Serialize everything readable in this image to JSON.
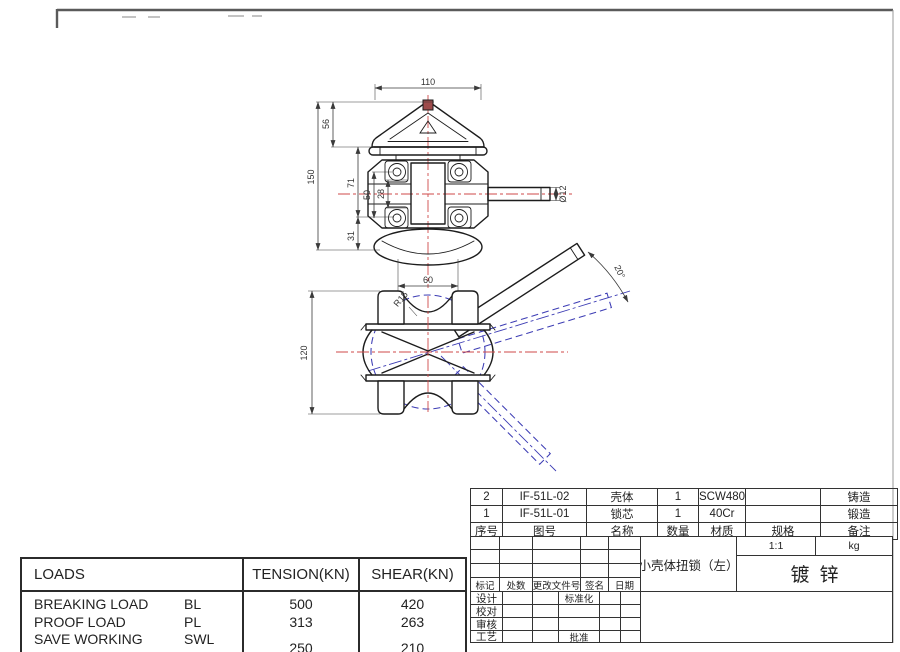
{
  "drawing": {
    "colors": {
      "outline": "#1c1c1c",
      "centerline": "#cf4a4a",
      "alternate_position": "#3c3cb4",
      "dimension": "#3a3a3a"
    },
    "top_view": {
      "dims": {
        "width": "110",
        "head_height": "56",
        "overall_height": "150",
        "body_height": "71",
        "bolt_spacing": "50",
        "inner_spacing": "28",
        "flange_height": "31",
        "flange_width": "60",
        "rod_dia": "Ø12"
      }
    },
    "front_view": {
      "dims": {
        "height": "120",
        "saddle_radius": "R15",
        "handle_angle": "20°"
      }
    }
  },
  "loads_table": {
    "header": {
      "loads": "LOADS",
      "tension": "TENSION(KN)",
      "shear": "SHEAR(KN)"
    },
    "rows": [
      {
        "name": "BREAKING LOAD",
        "abbr": "BL",
        "tension": "500",
        "shear": "420"
      },
      {
        "name": "PROOF LOAD",
        "abbr": "PL",
        "tension": "313",
        "shear": "263"
      },
      {
        "name": "SAVE WORKING LOAD",
        "abbr": "SWL",
        "tension": "250",
        "shear": "210"
      }
    ]
  },
  "parts_table": {
    "header": {
      "seq": "序号",
      "dwg_no": "图号",
      "name": "名称",
      "qty": "数量",
      "material": "材质",
      "spec": "规格",
      "remark": "备注"
    },
    "rows": [
      {
        "seq": "2",
        "dwg_no": "IF-51L-02",
        "name": "壳体",
        "qty": "1",
        "material": "SCW480",
        "spec": "",
        "remark": "铸造"
      },
      {
        "seq": "1",
        "dwg_no": "IF-51L-01",
        "name": "锁芯",
        "qty": "1",
        "material": "40Cr",
        "spec": "",
        "remark": "锻造"
      }
    ]
  },
  "title_block": {
    "title": "小壳体扭锁（左）",
    "scale": "1:1",
    "weight_unit": "kg",
    "finish": "镀锌",
    "revision_header": {
      "mark": "标记",
      "count": "处数",
      "doc_no": "更改文件号",
      "sign": "签名",
      "date": "日期"
    },
    "staff": {
      "design": "设计",
      "check": "校对",
      "review": "审核",
      "process": "工艺",
      "standard": "标准化",
      "approve": "批准"
    }
  }
}
